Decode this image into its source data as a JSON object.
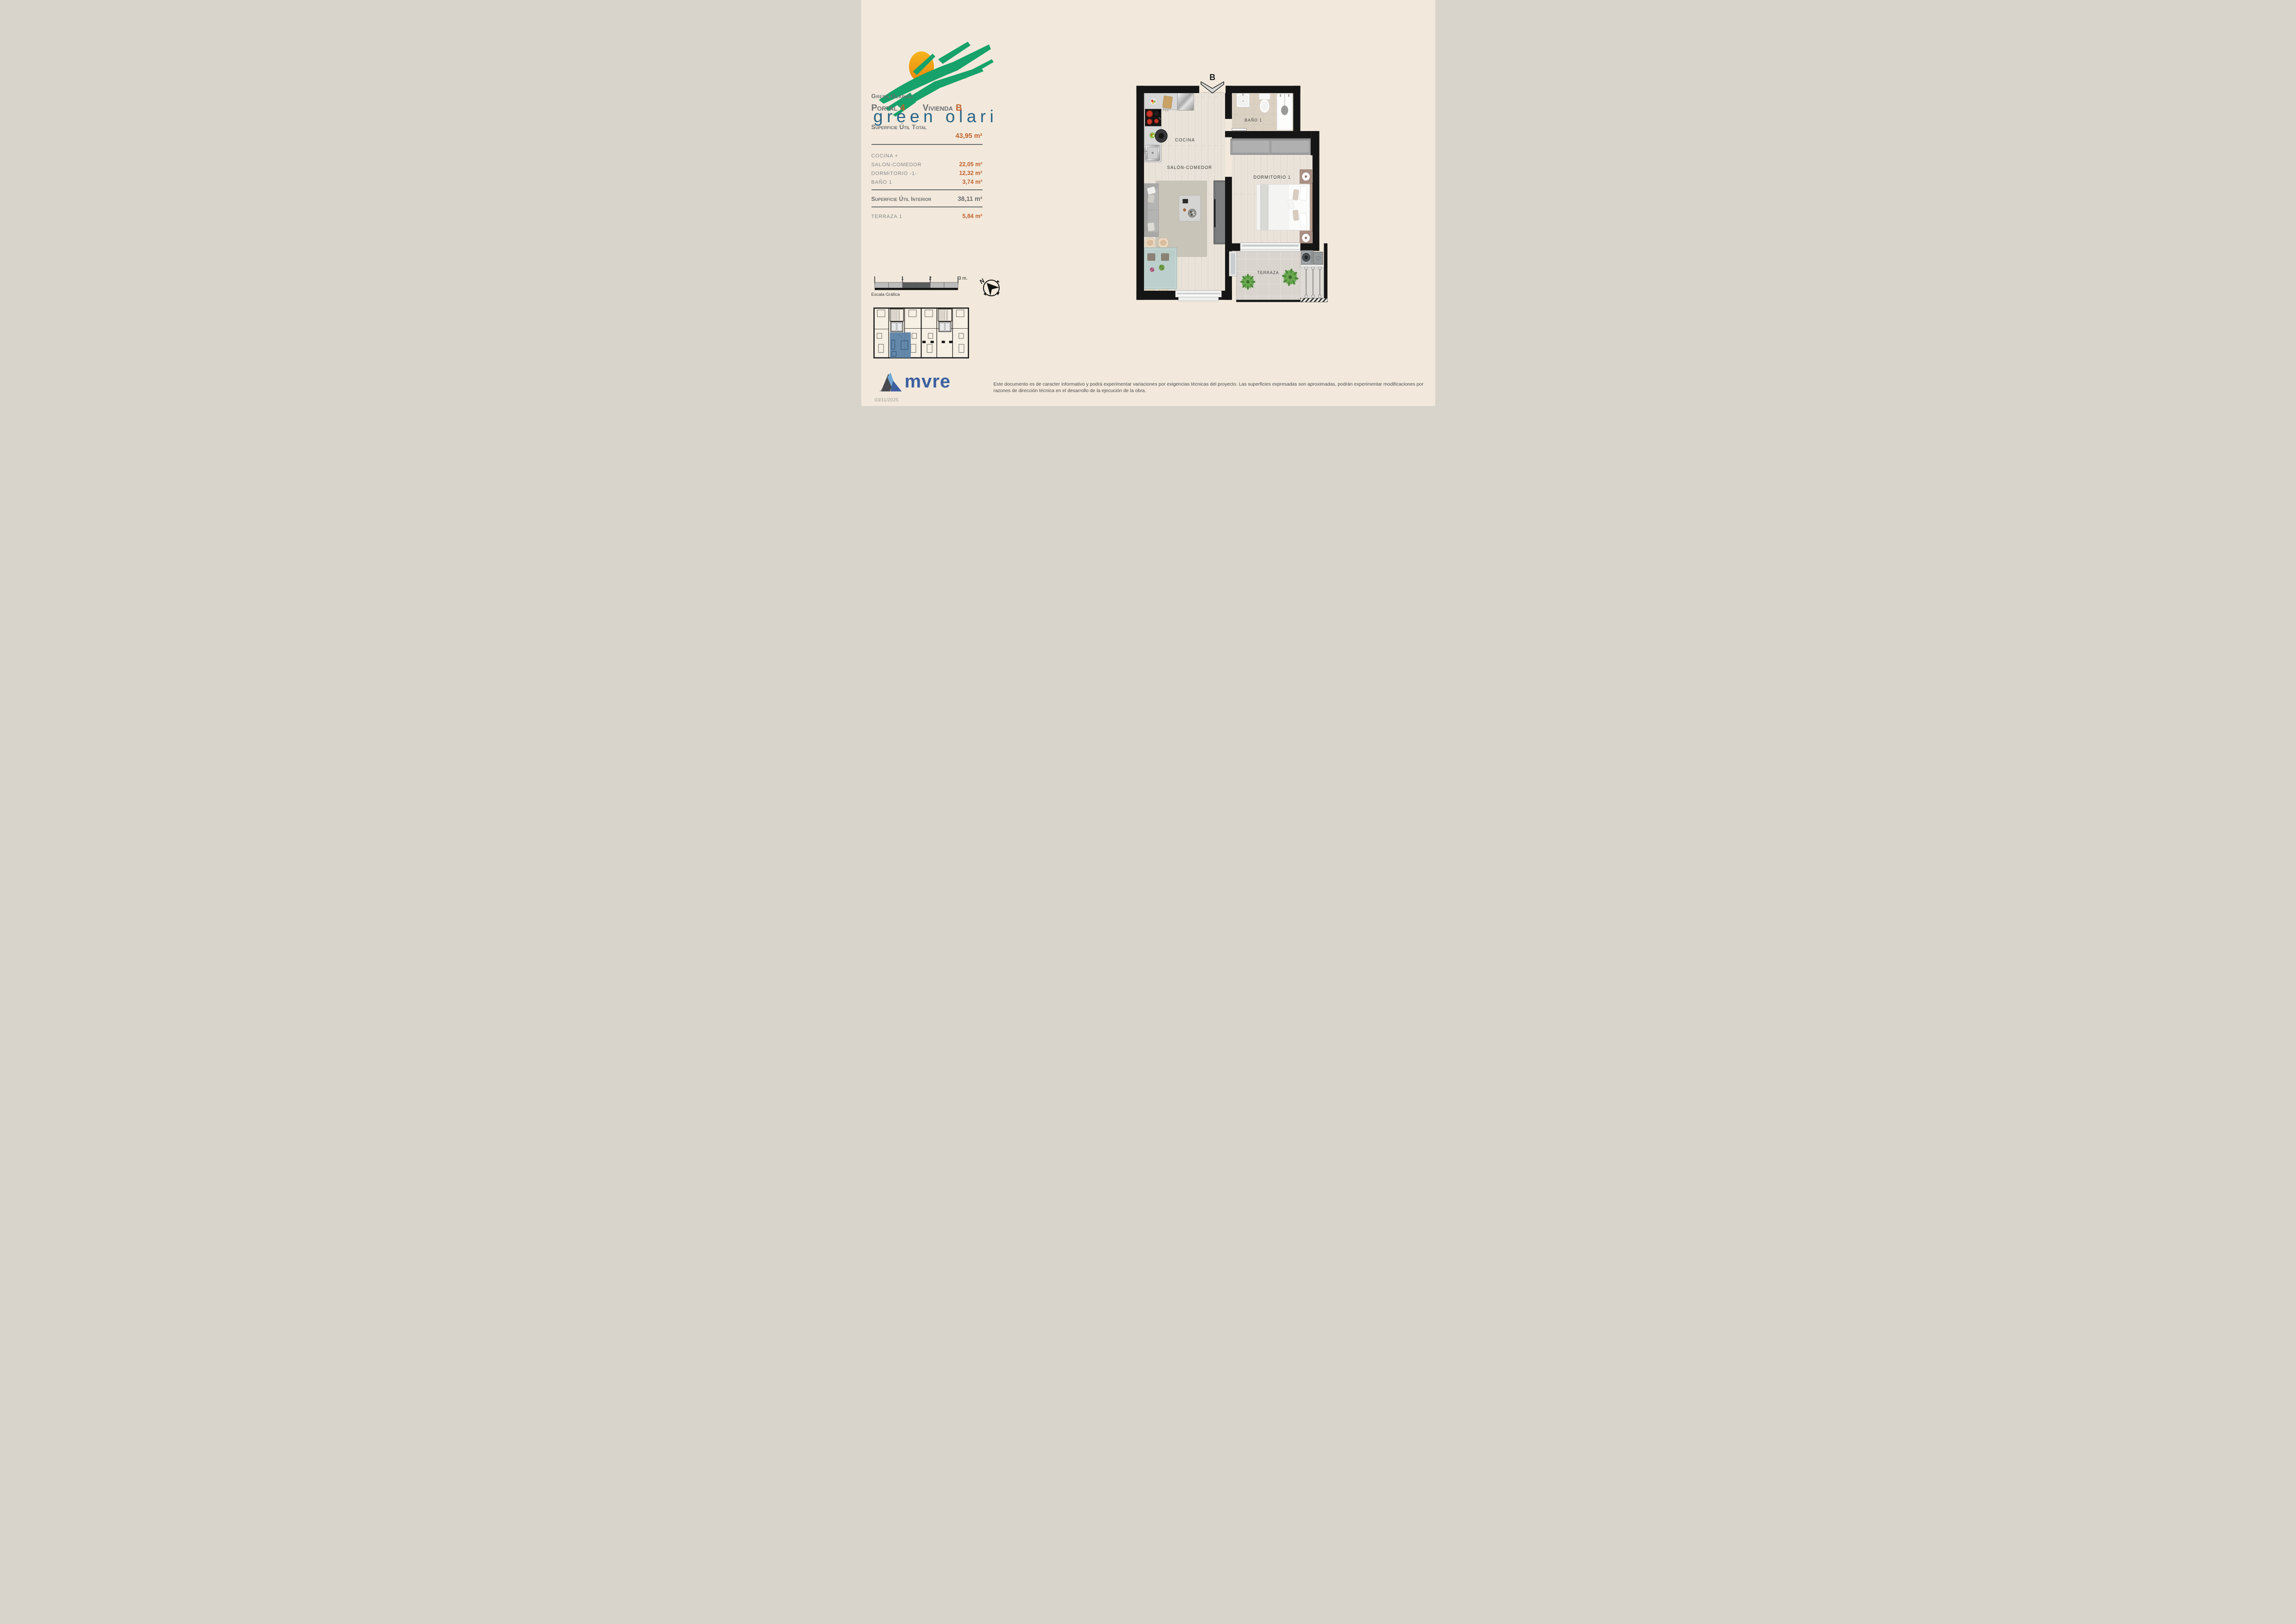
{
  "logo": {
    "wordmark": "green olarizu"
  },
  "info": {
    "project": "Green Olarizu",
    "portal_label": "Portal",
    "portal_number": "4",
    "dwelling_label": "Vivienda",
    "dwelling_letter": "B",
    "total_label": "Superficie Útil Total",
    "total_value": "43,95 m²",
    "rooms": [
      {
        "label": "COCINA +",
        "value": ""
      },
      {
        "label": "SALON-COMEDOR",
        "value": "22,05 m²"
      },
      {
        "label": "DORMITORIO -1-",
        "value": "12,32 m²"
      },
      {
        "label": "BAÑO 1",
        "value": "3,74 m²"
      }
    ],
    "interior_label": "Superficie Útil Interior",
    "interior_value": "38,11 m²",
    "terrace_label": "TERRAZA 1",
    "terrace_value": "5,84 m²"
  },
  "scale": {
    "ticks": [
      "1",
      "2",
      "3 m."
    ],
    "caption": "Escala Gráfica"
  },
  "compass": {
    "north": "N"
  },
  "plan": {
    "entrance_label": "B",
    "labels": {
      "kitchen": "COCINA",
      "living": "SALÓN-COMEDOR",
      "bath": "BAÑO 1",
      "bedroom": "DORMITORIO 1",
      "terrace": "TERRAZA"
    }
  },
  "footer": {
    "brand": "mvre",
    "date": "03/11/2025",
    "disclaimer": "Este documento es de caracter informativo y podrá experimentar variaciones por exigencias técnicas del proyecto. Las superficies expresadas son aproximadas, podrán experimentar modificaciones por razones de dirección técnica en el desarrollo de la ejecución de la obra."
  },
  "colors": {
    "accent_orange": "#c2612c",
    "text_gray": "#6d6e71",
    "highlight_blue": "#5d83a8",
    "logo_green": "#16a26a",
    "logo_sun": "#f0a312",
    "logo_text_blue": "#2a6486",
    "mvre_blue": "#3c5f9f",
    "wall_black": "#151515",
    "background": "#f2e9dc"
  }
}
